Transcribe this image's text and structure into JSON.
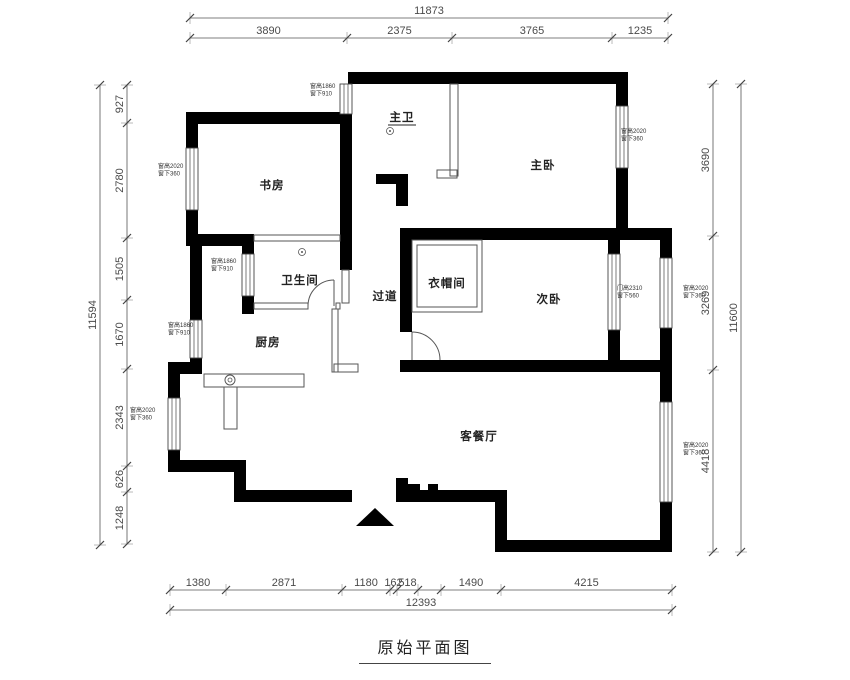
{
  "title": {
    "text": "原始平面图"
  },
  "rooms": [
    {
      "id": "master-bath",
      "label": "主卫"
    },
    {
      "id": "study",
      "label": "书房"
    },
    {
      "id": "master-bedroom",
      "label": "主卧"
    },
    {
      "id": "bathroom",
      "label": "卫生间"
    },
    {
      "id": "cloakroom",
      "label": "衣帽间"
    },
    {
      "id": "second-bedroom",
      "label": "次卧"
    },
    {
      "id": "corridor",
      "label": "过道"
    },
    {
      "id": "kitchen",
      "label": "厨房"
    },
    {
      "id": "living-dining",
      "label": "客餐厅"
    }
  ],
  "window_annotations": [
    {
      "id": "a1",
      "lines": [
        "窗高1860",
        "窗下910"
      ]
    },
    {
      "id": "a2",
      "lines": [
        "窗高2020",
        "窗下360"
      ]
    },
    {
      "id": "a3",
      "lines": [
        "窗高2020",
        "窗下360"
      ]
    },
    {
      "id": "a4",
      "lines": [
        "窗高1860",
        "窗下910"
      ]
    },
    {
      "id": "a5",
      "lines": [
        "窗高1860",
        "窗下910"
      ]
    },
    {
      "id": "a6",
      "lines": [
        "窗高2020",
        "窗下360"
      ]
    },
    {
      "id": "a7",
      "lines": [
        "门高2310",
        "窗下560"
      ]
    },
    {
      "id": "a8",
      "lines": [
        "窗高2020",
        "窗下360"
      ]
    },
    {
      "id": "a9",
      "lines": [
        "窗高2020",
        "窗下360"
      ]
    }
  ],
  "dimensions": {
    "top": {
      "total": "11873",
      "segments": [
        "3890",
        "2375",
        "3765",
        "1235"
      ]
    },
    "left": {
      "total": "11594",
      "segments": [
        "927",
        "2780",
        "1505",
        "1670",
        "2343",
        "626",
        "1248"
      ]
    },
    "right": {
      "total": "11600",
      "segments": [
        "3690",
        "3269",
        "4418"
      ]
    },
    "bottom": {
      "total": "12393",
      "segments": [
        "1380",
        "2871",
        "1180",
        "162",
        "518",
        "",
        "1490",
        "4215"
      ]
    }
  }
}
